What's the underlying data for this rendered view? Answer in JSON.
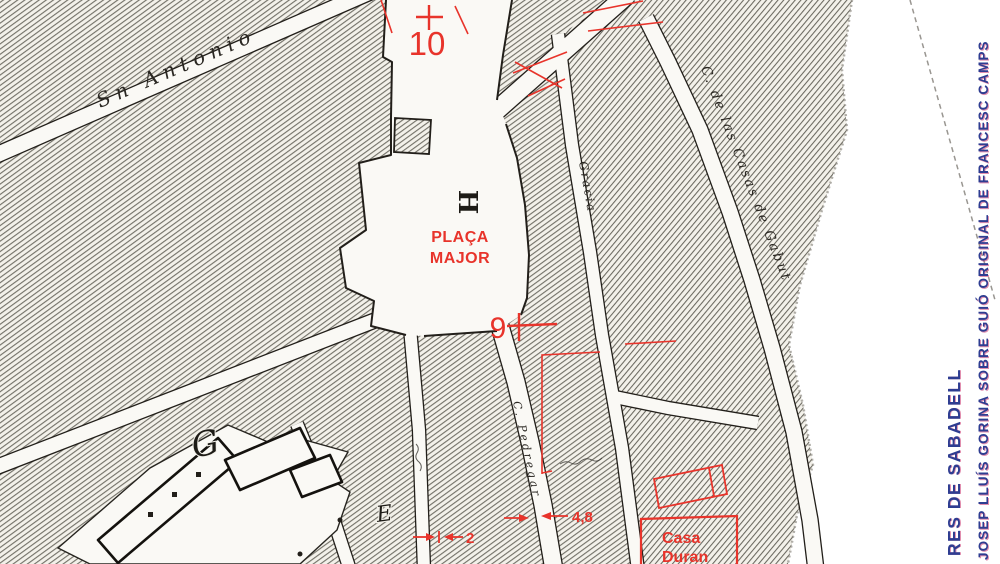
{
  "colors": {
    "red": "#e8342b",
    "ink": "#221f1a",
    "paper": "#faf9f5",
    "map_paper": "#f3f1ea",
    "hatch_line": "#6a685f",
    "caption_blue": "#2e3d91",
    "caption_fringe": "#c9356f",
    "dash_gray": "#999691"
  },
  "map": {
    "plaza": {
      "label_line1": "PLAÇA",
      "label_line2": "MAJOR"
    },
    "markers": {
      "point_10": "10",
      "point_9": "9"
    },
    "block_letters": {
      "h": "H",
      "g": "G",
      "e": "E"
    },
    "street_labels": {
      "san_antonio": "Sn Antonio",
      "casas_gabut": "C. de las Casas de Gabut",
      "gracia": "Gracia",
      "pedregar": "C. Pedregar"
    },
    "red_annotations": {
      "casa_line1": "Casa",
      "casa_line2": "Duran",
      "dim_pedregar_width": "4,8",
      "dim_left_street_width": "2"
    }
  },
  "margin_captions": {
    "title_fragment": "RES DE SABADELL",
    "credit": "JOSEP LLUÍS GORINA SOBRE GUIÓ ORIGINAL DE FRANCESC CAMPS"
  }
}
